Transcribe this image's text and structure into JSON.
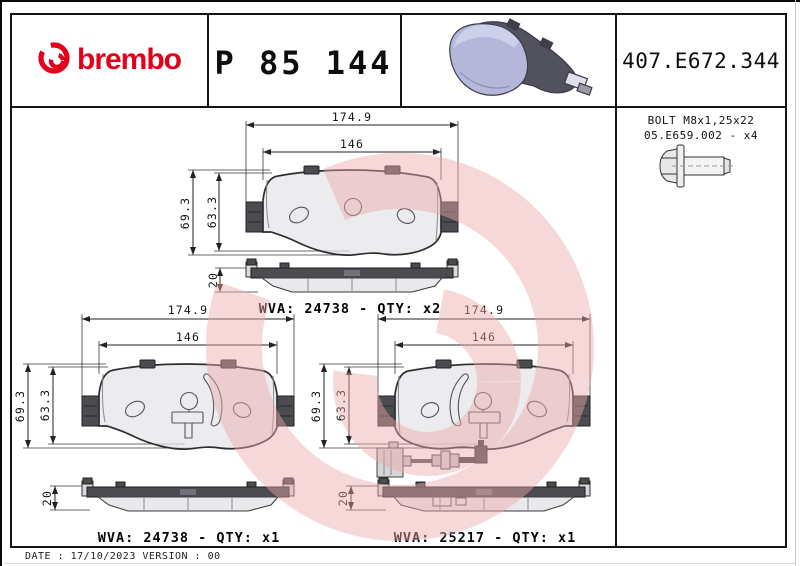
{
  "header": {
    "brand_wordmark": "brembo",
    "part_code": "P 85 144",
    "catalog_code": "407.E672.344"
  },
  "bolt_info": {
    "line1": "BOLT M8x1,25x22",
    "line2": "05.E659.002 - x4"
  },
  "dimensions": {
    "total_width": "174.9",
    "pad_width": "146",
    "total_height": "69.3",
    "pad_height": "63.3",
    "thickness": "20"
  },
  "drawings": [
    {
      "id": "top",
      "wva_label": "WVA: 24738 - QTY: x2"
    },
    {
      "id": "bottom-left",
      "wva_label": "WVA: 24738 - QTY: x1"
    },
    {
      "id": "bottom-right",
      "wva_label": "WVA: 25217 - QTY: x1"
    }
  ],
  "footer": {
    "date_line": "DATE : 17/10/2023 VERSION : 00"
  },
  "colors": {
    "brand_red": "#e2001a",
    "watermark_pink": "#eda9a9",
    "pad_lavender": "#b4b7da"
  }
}
